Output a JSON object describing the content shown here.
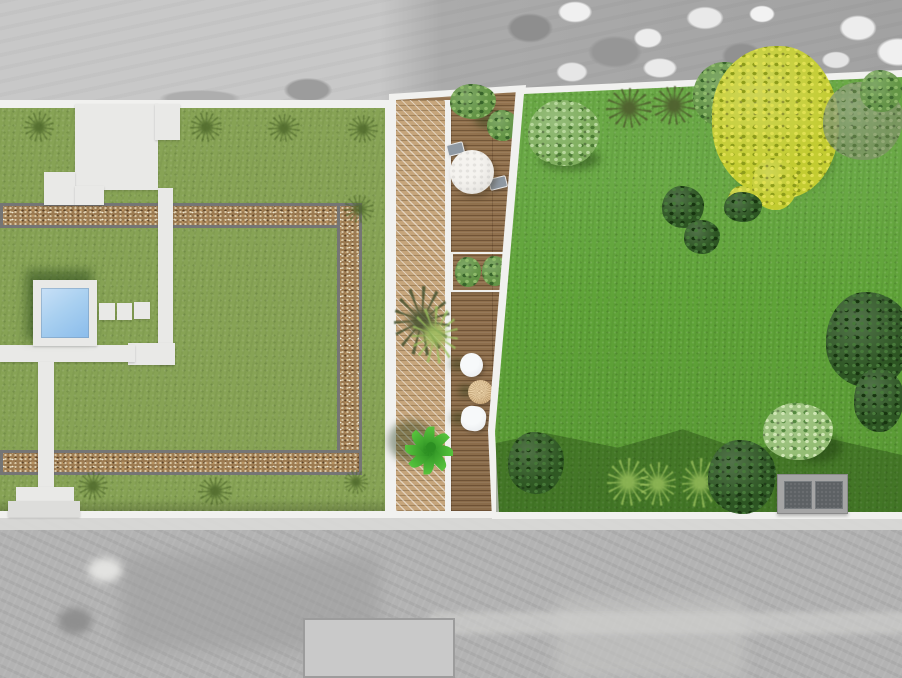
{
  "scene": {
    "type": "garden-landscape-design-plan",
    "view": "top-down / bird's-eye rendering",
    "background": "grayscale aerial photograph of neighboring parcels above and below the plan",
    "areas": [
      {
        "name": "left-garden",
        "description": "olive-green lawn framed by a rectangular gravel path with gray edging, white patio and walkway network, square plunge pool with white surround, three stepping stones, scattered grass tufts"
      },
      {
        "name": "deck-terrace",
        "description": "timber deck strip between the two gardens; lighter diagonally-hatched deck band on its left; white edge borders; tapers toward the bottom"
      },
      {
        "name": "right-garden",
        "description": "bright green open lawn bordered by a white boundary strip, mature trees along the top, shaded planting bed along the bottom with shrubs, grasses and a storage shed"
      }
    ],
    "objects": [
      {
        "name": "plunge-pool",
        "count": 1,
        "description": "square pool, light blue water, white deck surround, dark shadow to upper-left"
      },
      {
        "name": "stepping-stones",
        "count": 3,
        "description": "small white squares right of the pool"
      },
      {
        "name": "patio-terrace",
        "count": 1,
        "description": "stepped white patio at top of left garden"
      },
      {
        "name": "gravel-path-border",
        "count": 1,
        "description": "rectangular gravel band with dark gray edges framing the left lawn"
      },
      {
        "name": "round-dining-table",
        "count": 1,
        "description": "white round table on deck with two gray chairs"
      },
      {
        "name": "deck-chairs",
        "count": 2
      },
      {
        "name": "planter-box-shrubs",
        "count": 2,
        "description": "two round shrubs in a white-edged planter on the deck"
      },
      {
        "name": "ornamental-grasses",
        "count": 2,
        "description": "feathery grasses on the hatched deck band"
      },
      {
        "name": "side-stools",
        "count": 3,
        "description": "two white stools and one rattan/tan stool on lower deck"
      },
      {
        "name": "potted-plant",
        "count": 1,
        "description": "large green leafy plant on lower deck"
      },
      {
        "name": "large-yellow-tree",
        "count": 1,
        "description": "big yellow-green tree at top right, canopy overhangs the boundary"
      },
      {
        "name": "trees-and-bushes",
        "count": 12,
        "description": "light dappled tree, spiky shrubs, green and faded trees, dark bushes, right-edge tree"
      },
      {
        "name": "planting-bed",
        "count": 1,
        "description": "shaded bed along bottom of right garden with grasses and shrubs"
      },
      {
        "name": "garden-storage-shed",
        "count": 1,
        "description": "gray double-panel storage box at bottom right"
      }
    ]
  },
  "colors": {
    "photo_gray_light": "#c8c8c8",
    "photo_gray_dark": "#a2a2a2",
    "photo_bottom_gray": "#b3b3b3",
    "boundary_white": "#f1f1ef",
    "lawn_left": "#87a355",
    "lawn_right": "#5fa338",
    "gravel_base": "#9c7b52",
    "gravel_edge": "#757575",
    "path_white": "#e9e9e7",
    "pool_water_light": "#c8e0f7",
    "pool_water_dark": "#8abceb",
    "deck_wood": "#9b7953",
    "deck_wood_light": "#c6a57b",
    "table_white": "#eae8e4",
    "chair_gray": "#8f99a3",
    "stool_tan": "#d8b88a",
    "stool_white": "#edeff1",
    "plant_green_light": "#57c43d",
    "plant_green_dark": "#2c8f22",
    "tree_yellow_light": "#e0e052",
    "tree_yellow": "#c3cc31",
    "tree_yellow_dark": "#8d9c1a",
    "tree_green_light": "#8fba6b",
    "tree_green": "#639446",
    "tree_green_dark": "#37632a",
    "tree_lightgreen_light": "#b7d79c",
    "tree_lightgreen": "#7fae5e",
    "tree_lightgreen_dark": "#4a7a33",
    "bush_dark_light": "#47793a",
    "bush_dark": "#2d5523",
    "bush_dark_dark": "#16340f",
    "tree_faded_light": "#9aa97f",
    "tree_faded": "#7c9464",
    "tree_faded_dark": "#55703f",
    "shrub_var_light": "#cfe6b4",
    "shrub_var": "#94bd74",
    "shrub_var_dark": "#558940",
    "tuft_dark": "#4a6428",
    "tuft_light": "#9cc25e",
    "shed_frame": "#a5a5a5",
    "shed_panel": "#5d6164"
  }
}
